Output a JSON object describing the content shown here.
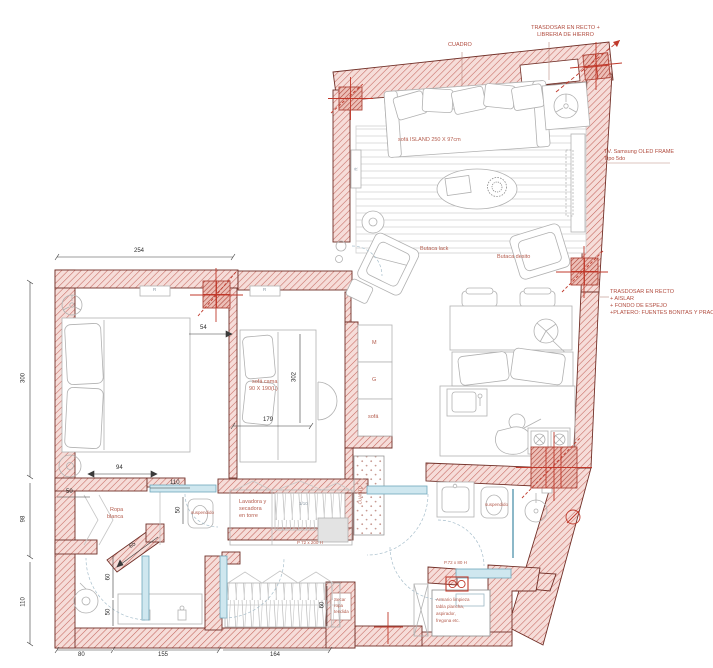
{
  "plan": {
    "colors": {
      "wall_hatch": "#c4665e",
      "wall_fill": "#f6ddd9",
      "wall_outline": "#713028",
      "column_red": "#ad4337",
      "annotation_red": "#b45c4d",
      "dimension": "#2e2e2e",
      "door_teal": "#6fa7bb"
    },
    "labels": {
      "cuadro": "CUADRO",
      "trasdosar_top_1": "TRASDOSAR EN RECTO +",
      "trasdosar_top_2": "LIBRERIA DE HIERRO",
      "tv_1": "TV. Samsung OLED FRAME",
      "tv_2": "Tipo 5do",
      "trasdosar_right_1": "TRASDOSAR EN RECTO",
      "trasdosar_right_2": "+ AISLAR",
      "trasdosar_right_3": "+ FONDO DE ESPEJO",
      "trasdosar_right_4": "+PLATERO: FUENTES BONITAS Y PRACTICO",
      "sofa_island": "sofá ISLAND 250 X 97cm",
      "butaca_left": "Butaca lack",
      "butaca_right": "Butaca desito",
      "sofa_cama_1": "sofá cama",
      "sofa_cama_2": "90 X 190(L)",
      "radiator": "R",
      "ropa_1": "Ropa",
      "ropa_2": "blanca",
      "suspendido": "suspendido",
      "closet_m": "M",
      "closet_g": "G",
      "closet_sofa": "sofá",
      "cuarto": "CUARTO",
      "lavadora_1": "Lavadora y",
      "lavadora_2": "secadora",
      "lavadora_3": "en torre",
      "ratio": "1/10",
      "door_hall": "P 72 x 200 H",
      "door_armario": "P.72 x 80 H",
      "armario_1": "Armario limpieza",
      "armario_2": "tabla plancha,",
      "armario_3": "aspirador,",
      "armario_4": "fregona etc.",
      "secar_1": "Secar",
      "secar_2": "ropa",
      "secar_3": "tendida"
    },
    "dimensions": {
      "d254": "254",
      "d300": "300",
      "d98": "98",
      "d110_left": "110",
      "d54": "54",
      "d179": "179",
      "d302": "302",
      "d94": "94",
      "d50_a": "50",
      "d110_door": "110",
      "d50_b": "50",
      "d65": "65",
      "d60_a": "60",
      "d50_c": "50",
      "d60_b": "60",
      "d80": "80",
      "d155": "155",
      "d164": "164"
    }
  }
}
